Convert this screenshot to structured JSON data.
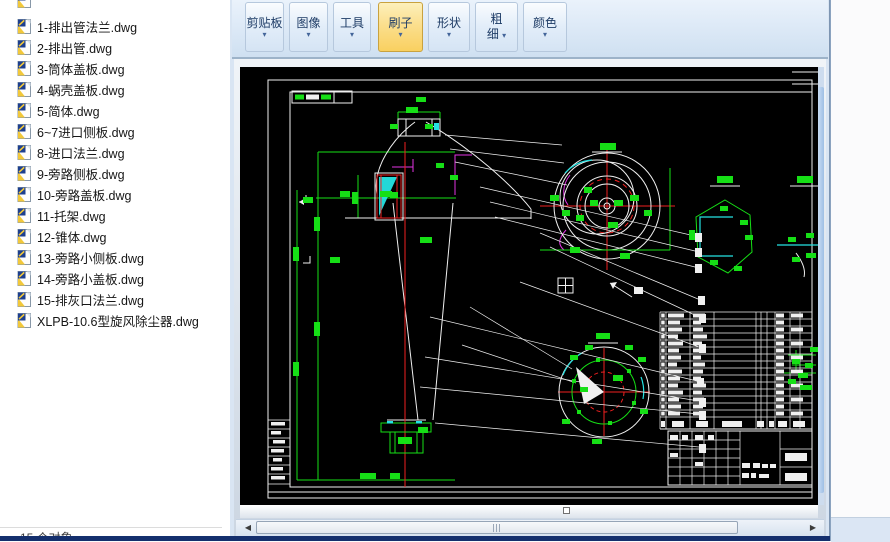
{
  "file_panel": {
    "files": [
      "1-排出管法兰.dwg",
      "2-排出管.dwg",
      "3-筒体盖板.dwg",
      "4-蜗壳盖板.dwg",
      "5-简体.dwg",
      "6~7进口侧板.dwg",
      "8-进口法兰.dwg",
      "9-旁路侧板.dwg",
      "10-旁路盖板.dwg",
      "11-托架.dwg",
      "12-锥体.dwg",
      "13-旁路小侧板.dwg",
      "14-旁路小盖板.dwg",
      "15-排灰口法兰.dwg",
      "XLPB-10.6型旋风除尘器.dwg"
    ],
    "status_text": "15 个对象"
  },
  "ribbon": {
    "dropdown_glyph": "▾",
    "groups": [
      {
        "label": "剪贴板",
        "active": false,
        "two_line": false
      },
      {
        "label": "图像",
        "active": false,
        "two_line": false
      },
      {
        "label": "工具",
        "active": false,
        "two_line": false
      },
      {
        "label": "刷子",
        "active": true,
        "two_line": false
      },
      {
        "label": "形状",
        "active": false,
        "two_line": false
      },
      {
        "label": "粗细",
        "active": false,
        "two_line": true
      },
      {
        "label": "颜色",
        "active": false,
        "two_line": false
      }
    ]
  },
  "scrollbars": {
    "left_arrow": "◀",
    "right_arrow": "▶"
  },
  "drawing_colors": {
    "background": "#000000",
    "line": "#f0f0f0",
    "dimension": "#16df16",
    "centerline": "#ef2020",
    "aux": "#e233e2",
    "hatch": "#25e3e3"
  }
}
